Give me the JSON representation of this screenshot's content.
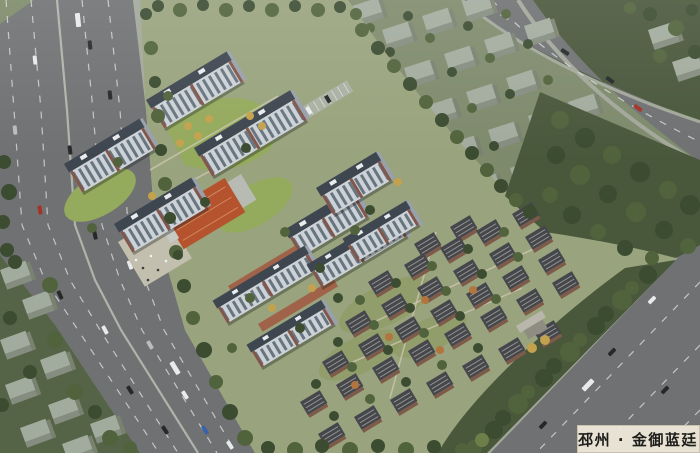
{
  "label": {
    "text": "邳州 · 金御蓝廷"
  },
  "palette": {
    "base": "#7e8a6c",
    "siteBase": "#99a37d",
    "road": "#6f7173",
    "roadDash": "#dadbdc",
    "walk": "#a2a79a",
    "forest": "#49573b",
    "forest2": "#556347",
    "treeDark": "#3b4c31",
    "treeMid": "#51633c",
    "treeLight": "#6d7f49",
    "treeYellow": "#c3a24e",
    "treeOrange": "#b2753e",
    "lawn": "#94aa5d",
    "lawn2": "#8d9a63",
    "ctxTop": "#a2ac9e",
    "ctxSide": "#848d7f",
    "ctxEnd": "#79816f",
    "hiRoof": "#3e4650",
    "hiFace": "#ccd2d7",
    "hiSide": "#98a1ab",
    "winStripe": "#55646f",
    "accent": "#82564a",
    "villaRoof": "#45474c",
    "villaWall": "#7d5a49",
    "ridge": "#9a9a94",
    "brick": "#a2503a",
    "entranceRoof": "#b5532f",
    "plaza": "#c3bfae",
    "labelBg": "#ece7d8",
    "labelText": "#1d1d1b",
    "carWhite": "#e8eaec",
    "carBlack": "#26282a",
    "carRed": "#a33327",
    "carBlue": "#3a62a8",
    "carSilver": "#b9bdc0"
  }
}
